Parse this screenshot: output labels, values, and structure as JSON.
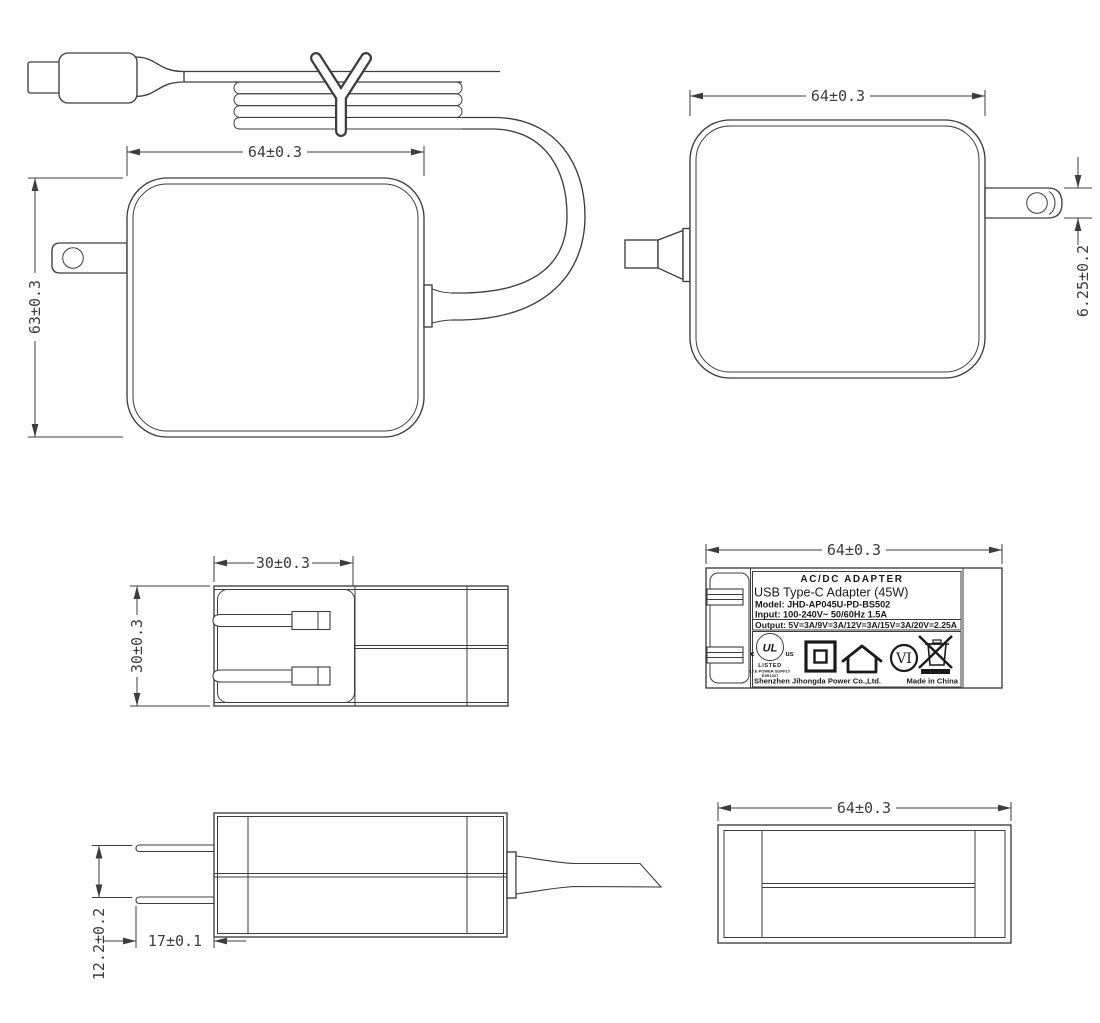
{
  "dimensions": {
    "front_width": "64±0.3",
    "front_height": "63±0.3",
    "rear_width": "64±0.3",
    "prong_thickness": "6.25±0.2",
    "fold_area_width": "30±0.3",
    "body_thickness": "30±0.3",
    "label_width": "64±0.3",
    "prong_spacing": "12.2±0.2",
    "prong_length": "17±0.1",
    "bottom_width": "64±0.3"
  },
  "label": {
    "heading": "AC/DC ADAPTER",
    "product": "USB Type-C Adapter (45W)",
    "model": "Model: JHD-AP045U-PD-BS502",
    "input": "Input: 100-240V~ 50/60Hz 1.5A",
    "output": "Output: 5V=3A/9V=3A/12V=3A/15V=3A/20V=2.25A",
    "company": "Shenzhen Jihongda Power Co.,Ltd.",
    "origin": "Made in China"
  },
  "marks": {
    "ul_letters": "UL",
    "ul_c": "c",
    "ul_us": "us",
    "ul_listed": "LISTED",
    "ul_type": "I.T.E POWER SUPPLY",
    "ul_file": "E3R1327",
    "efficiency": "VI"
  },
  "colors": {
    "line": "#3d3d3d",
    "background": "#ffffff"
  }
}
